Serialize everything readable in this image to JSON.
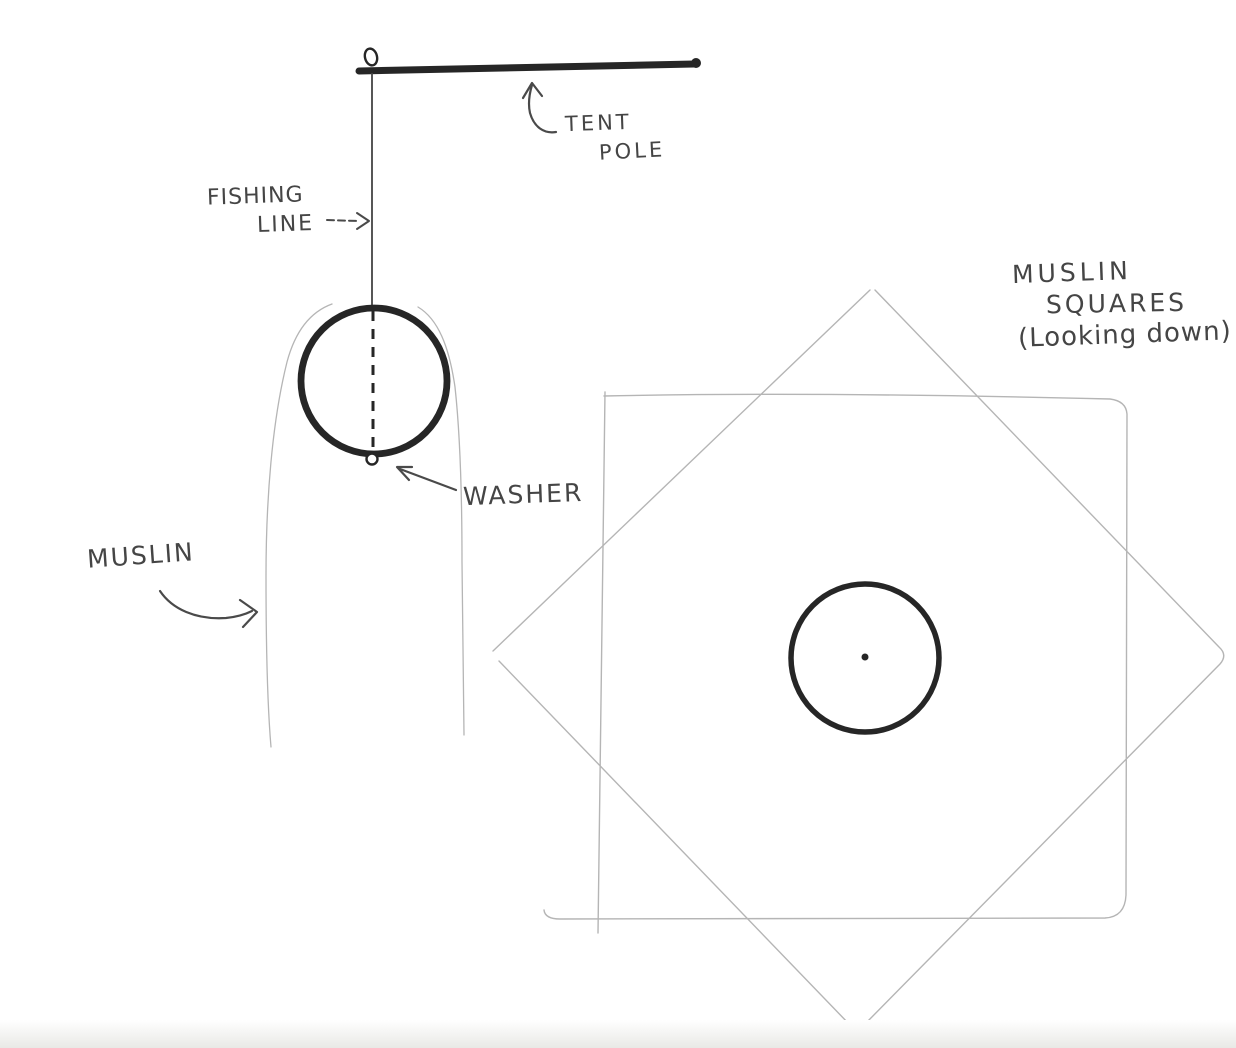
{
  "colors": {
    "ink_dark": "#262626",
    "pencil_text": "#454545",
    "pencil_light": "#b5b5b5"
  },
  "side_view": {
    "tent_pole_label": [
      "TENT",
      "POLE"
    ],
    "fishing_line_label": [
      "FISHING",
      "LINE"
    ],
    "washer_label": "WASHER",
    "muslin_label": "MUSLIN"
  },
  "plan_view": {
    "title": [
      "MUSLIN",
      "SQUARES",
      "(Looking down)"
    ]
  }
}
